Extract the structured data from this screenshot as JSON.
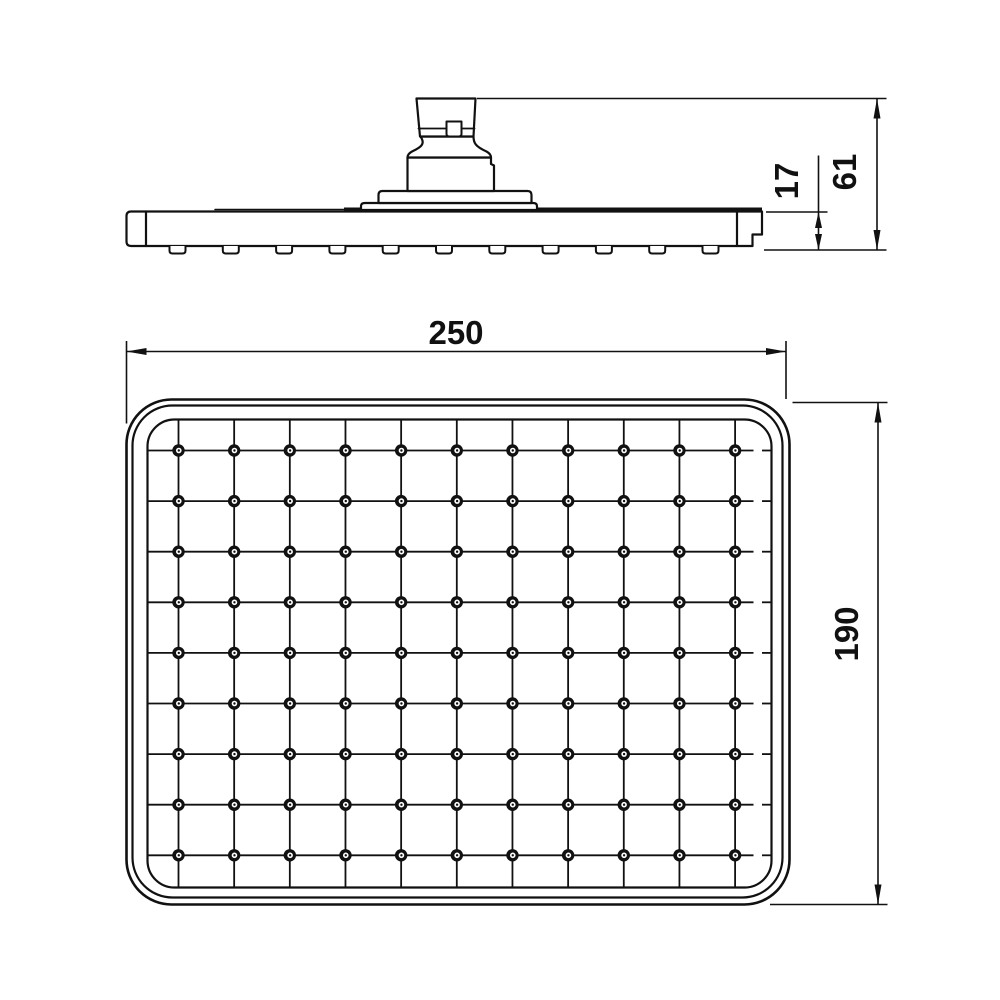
{
  "page": {
    "background": "#ffffff",
    "line_color": "#111111"
  },
  "drawing": {
    "views": {
      "side": {
        "id": "side-view"
      },
      "face": {
        "id": "face-view"
      }
    },
    "dimensions": {
      "face_width": "250",
      "face_height": "190",
      "total_height": "61",
      "head_thickness": "17"
    },
    "nozzle_grid": {
      "columns": 11,
      "rows": 9,
      "nozzle_count": 99
    }
  }
}
